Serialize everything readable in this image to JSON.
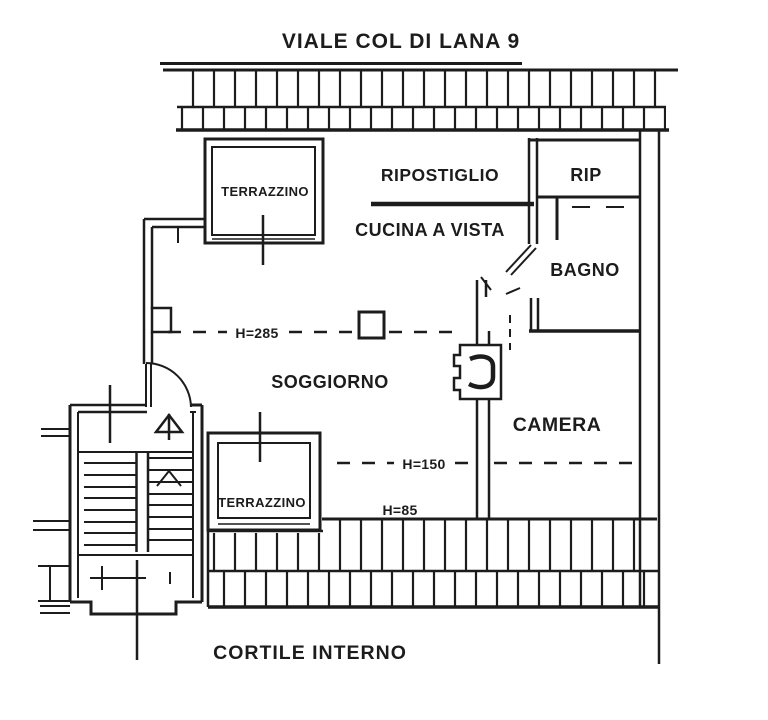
{
  "plan": {
    "title": "VIALE COL DI LANA 9",
    "rooms": {
      "terrazzino_top": "TERRAZZINO",
      "ripostiglio": "RIPOSTIGLIO",
      "rip": "RIP",
      "cucina": "CUCINA A VISTA",
      "bagno": "BAGNO",
      "soggiorno": "SOGGIORNO",
      "camera": "CAMERA",
      "terrazzino_bottom": "TERRAZZINO"
    },
    "annotations": {
      "h_soggiorno": "H=285",
      "h_camera": "H=150",
      "h_parapet": "H=85",
      "cortile": "CORTILE INTERNO"
    },
    "colors": {
      "ink": "#1c1c1c",
      "paper": "#ffffff"
    }
  }
}
